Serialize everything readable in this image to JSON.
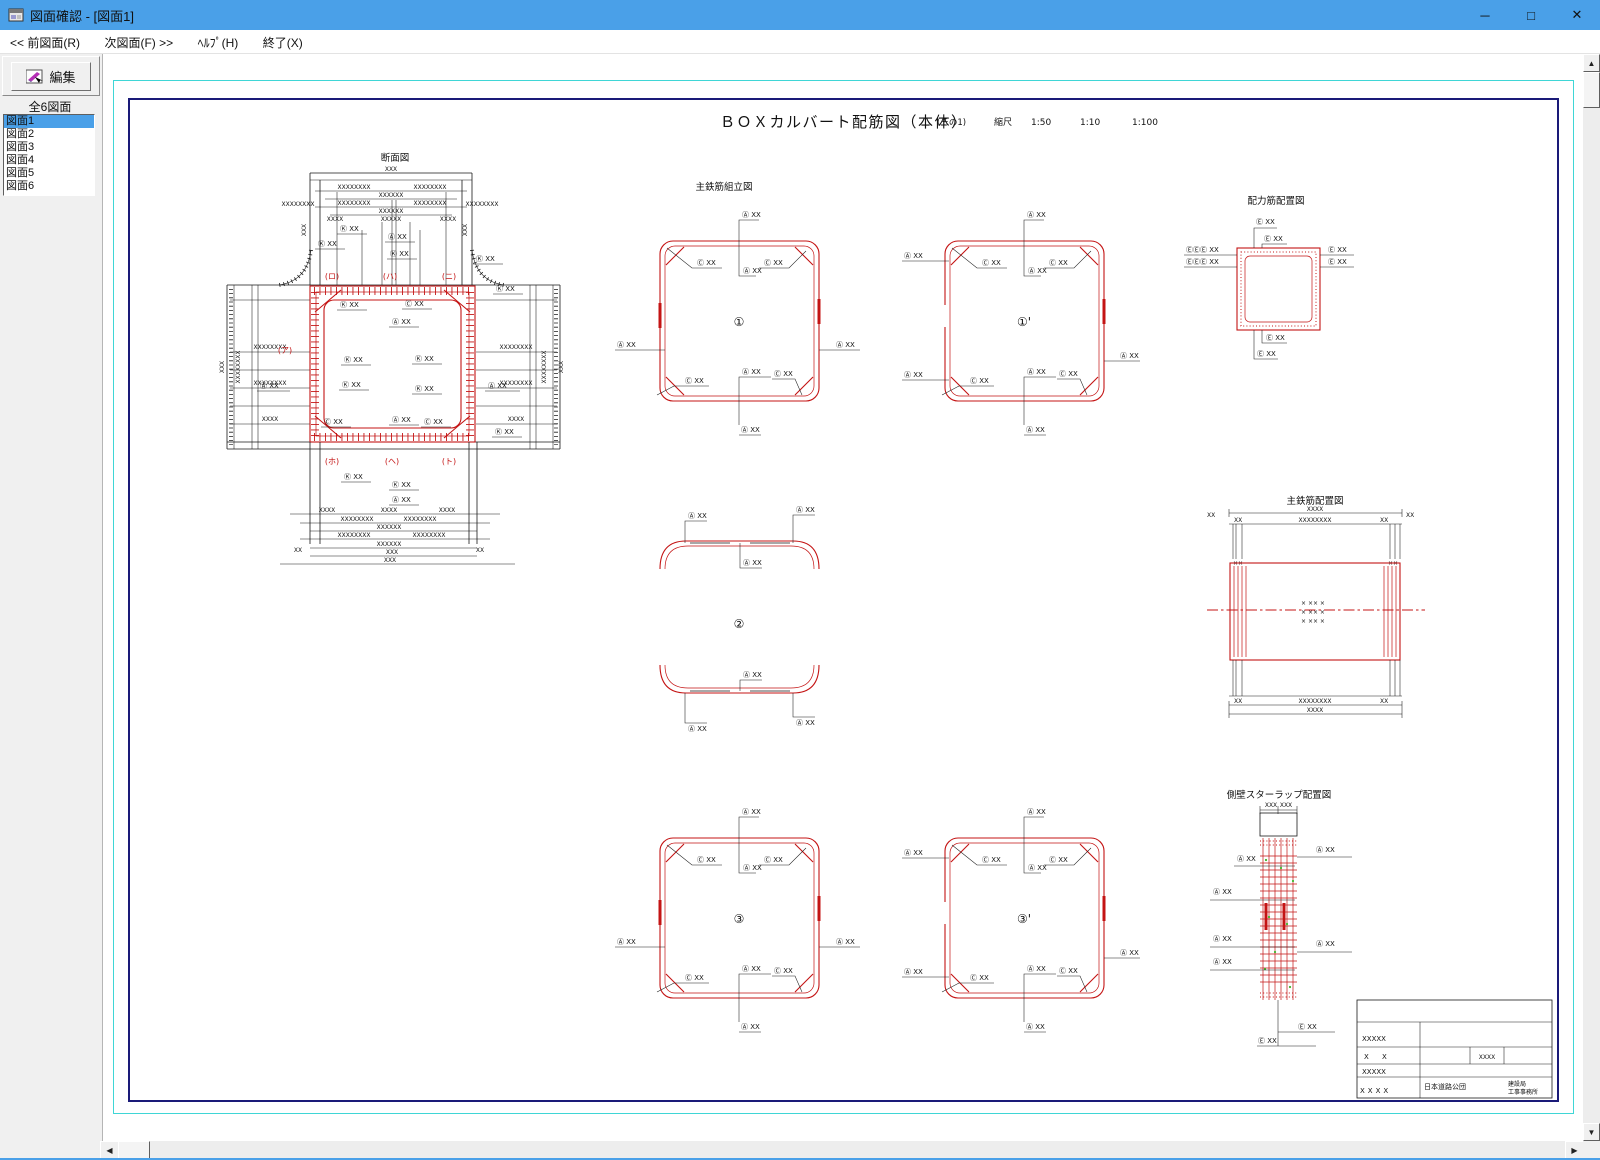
{
  "w": {
    "title": "図面確認 - [図面1]"
  },
  "icons": {
    "min": "─",
    "max": "□",
    "close": "✕",
    "up": "▲",
    "down": "▼",
    "left": "◀",
    "right": "▶"
  },
  "menu": {
    "items": [
      "<< 前図面(R)",
      "次図面(F) >>",
      "ﾍﾙﾌﾟ(H)",
      "終了(X)"
    ]
  },
  "sb": {
    "edit": "編集",
    "count": "全6図面",
    "items": [
      "図面1",
      "図面2",
      "図面3",
      "図面4",
      "図面5",
      "図面6"
    ],
    "selected": "図面1"
  },
  "dr": {
    "title": "ＢＯＸカルバート配筋図（本体）",
    "subtitle": "(その1)",
    "scale_label": "縮尺",
    "scales": [
      "1:50",
      "1:10",
      "1:100"
    ],
    "sec": {
      "cross": "断面図",
      "asm": "主鉄筋組立図",
      "dist": "配力筋配置図",
      "main": "主鉄筋配置図",
      "stir": "側壁スターラップ配置図"
    },
    "n": {
      "n1": "①",
      "n1p": "①'",
      "n2": "②",
      "n3": "③",
      "n3p": "③'"
    },
    "ld": {
      "a": "Ⓐ XX",
      "c": "Ⓒ XX",
      "e": "Ⓔ XX",
      "k": "Ⓚ XX",
      "e3": "ⒺⒺⒺ XX"
    },
    "rl": {
      "a": "(ア)",
      "ro": "(ロ)",
      "ha": "(ハ)",
      "ni": "(ニ)",
      "ho": "(ホ)",
      "he": "(ヘ)",
      "to": "(ト)"
    },
    "dm": {
      "xx": "XX",
      "xxx": "XXX",
      "x4": "XXXX",
      "x5": "XXXXX",
      "x6": "XXXXXX",
      "x8": "XXXXXXXX",
      "xx2": "××",
      "xrow": "×  ××  ×"
    },
    "tb": {
      "r2c1": "XXXXX",
      "r3a": "X",
      "r3b": "X",
      "r3c3": "XXXX",
      "r4c1": "XXXXX",
      "r5c1": "XXXX",
      "org": "日本道路公団",
      "d1": "建設局",
      "d2": "工事事務所"
    }
  },
  "colors": {
    "titlebar": "#4aa0e8",
    "selection": "#4aa0e8",
    "cad_red": "#c41414",
    "frame_cyan": "#3fd6d6",
    "frame_navy": "#1a1a78",
    "green_dot": "#3db528"
  }
}
